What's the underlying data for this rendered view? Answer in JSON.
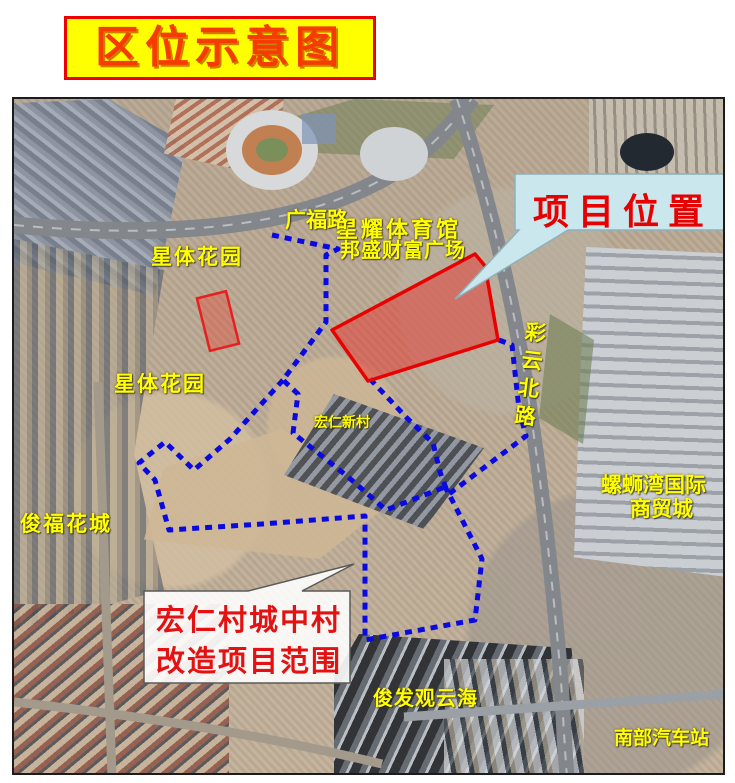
{
  "title": {
    "text": "区位示意图"
  },
  "map": {
    "labels": [
      {
        "id": "xingyao-stadium",
        "text": "星耀体育馆"
      },
      {
        "id": "guangfu-road",
        "text": "广福路"
      },
      {
        "id": "xingti-garden-north",
        "text": "星体花园"
      },
      {
        "id": "bangsheng-plaza",
        "text": "邦盛财富广场"
      },
      {
        "id": "xingti-garden-south",
        "text": "星体花园"
      },
      {
        "id": "hongren-village",
        "text": "宏仁新村"
      },
      {
        "id": "caiyun-north-road",
        "text": "彩云北路"
      },
      {
        "id": "luosiwan-intl-line1",
        "text": "螺蛳湾国际"
      },
      {
        "id": "luosiwan-intl-line2",
        "text": "商贸城"
      },
      {
        "id": "junfu-huacheng",
        "text": "俊福花城"
      },
      {
        "id": "junfa-guanyunhai",
        "text": "俊发观云海"
      },
      {
        "id": "south-bus-station",
        "text": "南部汽车站"
      }
    ],
    "callouts": {
      "project_location": {
        "text": "项目位置"
      },
      "renovation_range": {
        "line1": "宏仁村城中村",
        "line2": "改造项目范围"
      }
    }
  },
  "colors": {
    "title_text": "#f53b00",
    "title_bg": "#ffff00",
    "title_border": "#ee0000",
    "label_yellow": "#ffff00",
    "boundary_blue": "#0a0ae0",
    "site_red_stroke": "#e90000",
    "site_red_fill": "rgba(235,40,35,0.45)",
    "callout_bg": "#cbe7ee",
    "callout_text": "#e60000",
    "range_box_bg": "rgba(255,255,255,0.9)",
    "range_text": "#e31111"
  }
}
